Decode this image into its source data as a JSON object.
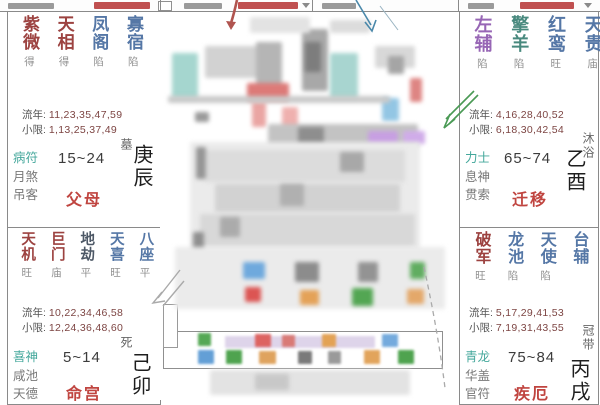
{
  "colors": {
    "star_red": "#9c4240",
    "star_blue": "#5577a6",
    "star_purple": "#9766b5",
    "star_teal": "#48897e",
    "star_dark": "#4d5866",
    "bright": "#909090",
    "god_teal": "#45a89c",
    "god_gray": "#787878",
    "palace_red": "#c04540",
    "numbers": "#7d4543",
    "label": "#555555",
    "stem": "#1e1e1e",
    "stage": "#666666",
    "arrow_red": "#b0544f",
    "arrow_blue": "#4a88aa",
    "arrow_green": "#4a9a55",
    "pencil": "#aaaaaa"
  },
  "palaces": [
    {
      "palace_name": "父母",
      "stem": "庚辰",
      "stage": "墓",
      "age": "15~24",
      "liunian_label": "流年:",
      "liunian": "11,23,35,47,59",
      "xiaoxian_label": "小限:",
      "xiaoxian": "1,13,25,37,49",
      "gods": [
        "病符",
        "月煞",
        "吊客"
      ],
      "stars": [
        {
          "n": "紫微",
          "b": "得",
          "c": "red"
        },
        {
          "n": "天相",
          "b": "得",
          "c": "red"
        },
        {
          "n": "凤阁",
          "b": "陷",
          "c": "blue"
        },
        {
          "n": "寡宿",
          "b": "陷",
          "c": "blue"
        },
        {
          "n": "阴煞",
          "b": "",
          "c": "blue"
        },
        {
          "n": "年解",
          "b": "庙",
          "c": "blue"
        }
      ]
    },
    {
      "palace_name": "命宫",
      "stem": "己卯",
      "stage": "死",
      "age": "5~14",
      "liunian_label": "流年:",
      "liunian": "10,22,34,46,58",
      "xiaoxian_label": "小限:",
      "xiaoxian": "12,24,36,48,60",
      "gods": [
        "喜神",
        "咸池",
        "天德"
      ],
      "stars": [
        {
          "n": "天机",
          "b": "旺",
          "c": "red"
        },
        {
          "n": "巨门",
          "b": "庙",
          "c": "red"
        },
        {
          "n": "地劫",
          "b": "平",
          "c": "dark"
        },
        {
          "n": "天喜",
          "b": "旺",
          "c": "blue"
        },
        {
          "n": "八座",
          "b": "平",
          "c": "blue"
        },
        {
          "n": "天月",
          "b": "",
          "c": "blue"
        },
        {
          "n": "咸池",
          "b": "平",
          "c": "blue"
        },
        {
          "n": "天德",
          "b": "平",
          "c": "blue"
        }
      ]
    },
    {
      "palace_name": "迁移",
      "stem": "乙酉",
      "stage": "沐浴",
      "age": "65~74",
      "liunian_label": "流年:",
      "liunian": "4,16,28,40,52",
      "xiaoxian_label": "小限:",
      "xiaoxian": "6,18,30,42,54",
      "gods": [
        "力士",
        "息神",
        "贯索"
      ],
      "stars": [
        {
          "n": "左辅",
          "b": "陷",
          "c": "purple"
        },
        {
          "n": "擎羊",
          "b": "陷",
          "c": "teal"
        },
        {
          "n": "红鸾",
          "b": "旺",
          "c": "blue"
        },
        {
          "n": "天贵",
          "b": "庙",
          "c": "blue"
        },
        {
          "n": "天才",
          "b": "旺",
          "c": "blue"
        }
      ]
    },
    {
      "palace_name": "疾厄",
      "stem": "丙戌",
      "stage": "冠带",
      "age": "75~84",
      "liunian_label": "流年:",
      "liunian": "5,17,29,41,53",
      "xiaoxian_label": "小限:",
      "xiaoxian": "7,19,31,43,55",
      "gods": [
        "青龙",
        "华盖",
        "官符"
      ],
      "stars": [
        {
          "n": "破军",
          "b": "旺",
          "c": "red"
        },
        {
          "n": "龙池",
          "b": "陷",
          "c": "blue"
        },
        {
          "n": "天使",
          "b": "陷",
          "c": "blue"
        },
        {
          "n": "台辅",
          "b": "",
          "c": "blue"
        },
        {
          "n": "旬空",
          "b": "陷",
          "c": "blue"
        },
        {
          "n": "华盖",
          "b": "平",
          "c": "blue"
        }
      ]
    }
  ]
}
